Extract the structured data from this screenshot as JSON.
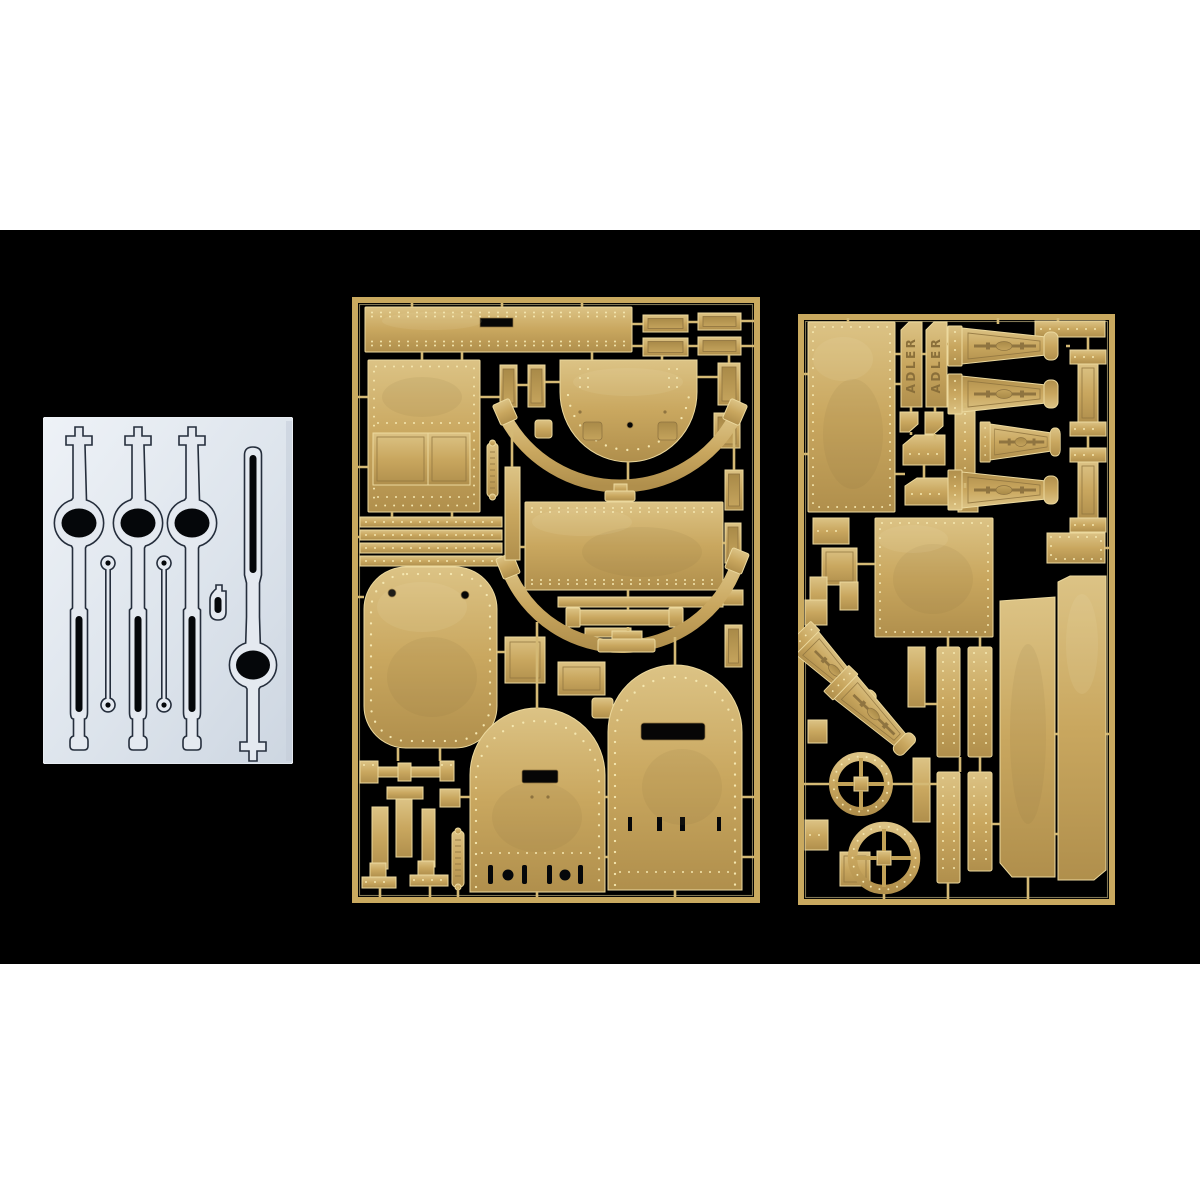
{
  "scene": {
    "description": "Product photograph of a scale-model photo-etched detail set: two brass frets and one pale die-cut film sheet arranged on a black background with white letterbox bands",
    "background_color": "#000000",
    "letterbox_color": "#ffffff"
  },
  "palette": {
    "brass": "#c9a75f",
    "brass_highlight": "#f4e7b0",
    "brass_shadow": "#8f7440",
    "film_sheet": "#e4e9f0",
    "film_outline": "#252e3c",
    "cutout_black": "#060606"
  },
  "film_sheet": {
    "label": "die-cut film sheet with lever and pushrod shapes"
  },
  "fret_a": {
    "label": "photo-etched brass fret A with riveted hull plates, curved strips and arched door plates"
  },
  "fret_b": {
    "label": "photo-etched brass fret B with nameplates, trail brackets, wheel rings and side panels",
    "nameplates": [
      "ADLER",
      "ADLER"
    ]
  }
}
